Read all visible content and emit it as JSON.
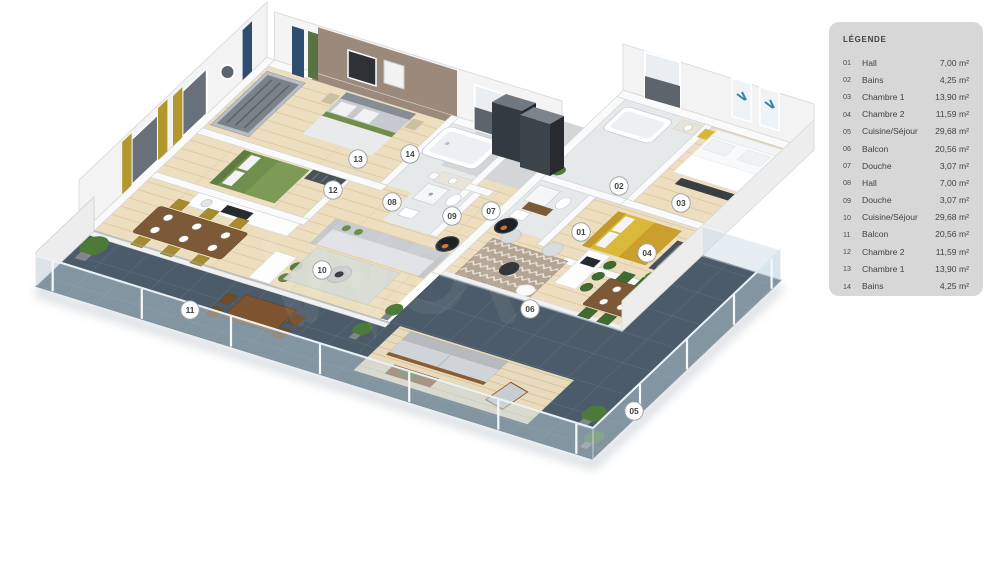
{
  "legend": {
    "title": "LÉGENDE",
    "items": [
      {
        "num": "01",
        "label": "Hall",
        "area": "7,00 m²"
      },
      {
        "num": "02",
        "label": "Bains",
        "area": "4,25 m²"
      },
      {
        "num": "03",
        "label": "Chambre 1",
        "area": "13,90 m²"
      },
      {
        "num": "04",
        "label": "Chambre 2",
        "area": "11,59 m²"
      },
      {
        "num": "05",
        "label": "Cuisine/Séjour",
        "area": "29,68 m²"
      },
      {
        "num": "06",
        "label": "Balcon",
        "area": "20,56 m²"
      },
      {
        "num": "07",
        "label": "Douche",
        "area": "3,07 m²"
      },
      {
        "num": "08",
        "label": "Hall",
        "area": "7,00 m²"
      },
      {
        "num": "09",
        "label": "Douche",
        "area": "3,07 m²"
      },
      {
        "num": "10",
        "label": "Cuisine/Séjour",
        "area": "29,68 m²"
      },
      {
        "num": "11",
        "label": "Balcon",
        "area": "20,56 m²"
      },
      {
        "num": "12",
        "label": "Chambre 2",
        "area": "11,59 m²"
      },
      {
        "num": "13",
        "label": "Chambre 1",
        "area": "13,90 m²"
      },
      {
        "num": "14",
        "label": "Bains",
        "area": "4,25 m²"
      }
    ]
  },
  "markers": [
    {
      "num": "01",
      "x": 581,
      "y": 232
    },
    {
      "num": "02",
      "x": 619,
      "y": 186
    },
    {
      "num": "03",
      "x": 681,
      "y": 203
    },
    {
      "num": "04",
      "x": 647,
      "y": 253
    },
    {
      "num": "05",
      "x": 634,
      "y": 411
    },
    {
      "num": "06",
      "x": 530,
      "y": 309
    },
    {
      "num": "07",
      "x": 491,
      "y": 211
    },
    {
      "num": "08",
      "x": 392,
      "y": 202
    },
    {
      "num": "09",
      "x": 452,
      "y": 216
    },
    {
      "num": "10",
      "x": 322,
      "y": 270
    },
    {
      "num": "11",
      "x": 190,
      "y": 310
    },
    {
      "num": "12",
      "x": 333,
      "y": 190
    },
    {
      "num": "13",
      "x": 358,
      "y": 159
    },
    {
      "num": "14",
      "x": 410,
      "y": 154
    }
  ],
  "colors": {
    "legend_bg": "#d7d7d7",
    "marker_text": "#3f4347",
    "terrace_tile": "#4c5b69",
    "wood_floor": "#eddec0",
    "accent_wall": "#9b8a7c",
    "curtain_mustard": "#b1972c",
    "curtain_blue": "#2e4d71",
    "bed_green": "#708e4c",
    "bed_yellow": "#d9b83a",
    "chair_green": "#3f6b33",
    "chair_olive": "#a68c2f",
    "glass_railing": "#c8dbe7"
  }
}
